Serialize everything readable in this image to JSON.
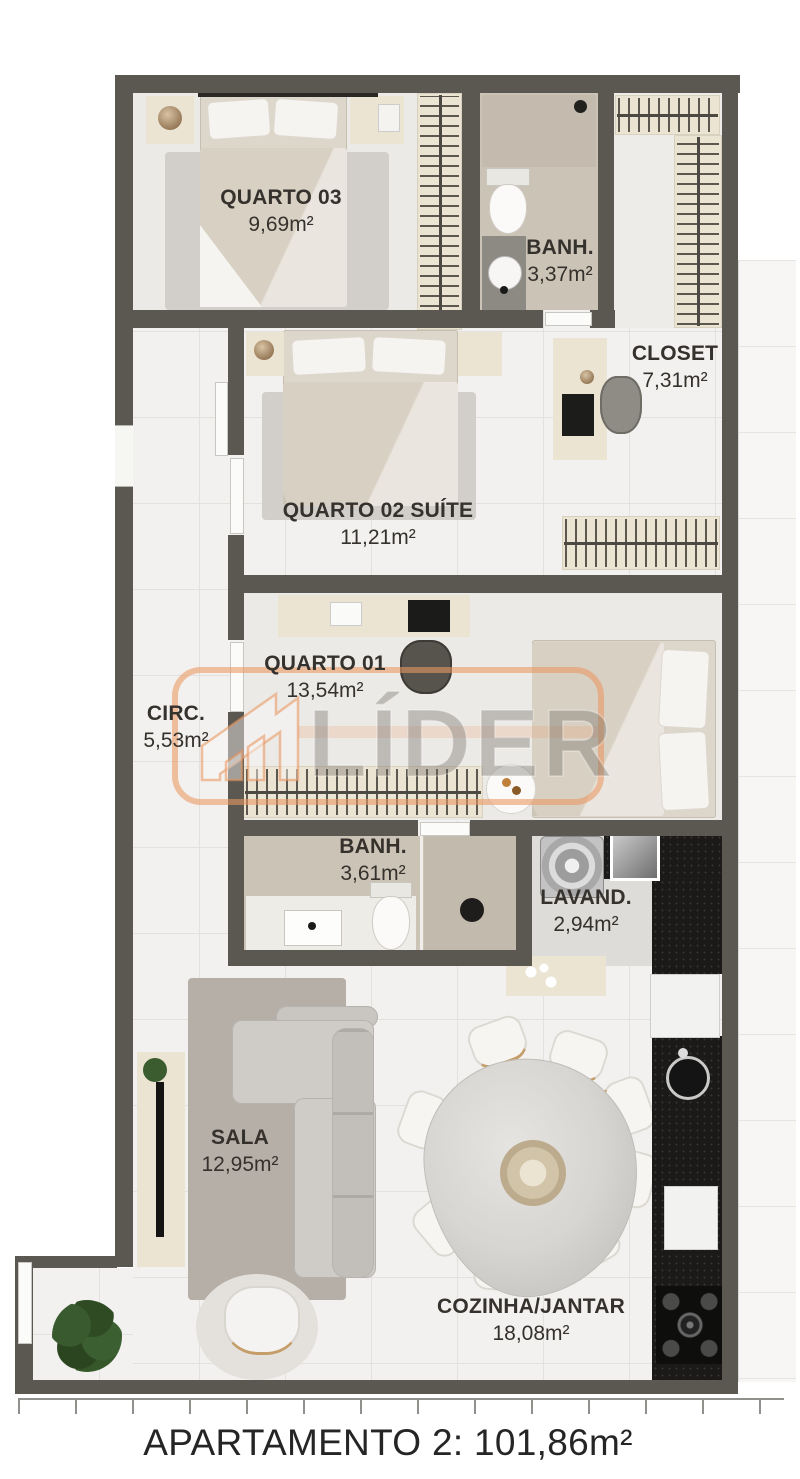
{
  "caption": "APARTAMENTO 2: 101,86m²",
  "watermark": {
    "brand": "LÍDER"
  },
  "rooms": [
    {
      "id": "quarto03",
      "name": "QUARTO 03",
      "area": "9,69m²"
    },
    {
      "id": "banh1",
      "name": "BANH.",
      "area": "3,37m²"
    },
    {
      "id": "closet",
      "name": "CLOSET",
      "area": "7,31m²"
    },
    {
      "id": "quarto02",
      "name": "QUARTO 02 SUÍTE",
      "area": "11,21m²"
    },
    {
      "id": "quarto01",
      "name": "QUARTO 01",
      "area": "13,54m²"
    },
    {
      "id": "circ",
      "name": "CIRC.",
      "area": "5,53m²"
    },
    {
      "id": "banh2",
      "name": "BANH.",
      "area": "3,61m²"
    },
    {
      "id": "lavand",
      "name": "LAVAND.",
      "area": "2,94m²"
    },
    {
      "id": "sala",
      "name": "SALA",
      "area": "12,95m²"
    },
    {
      "id": "cozinha",
      "name": "COZINHA/JANTAR",
      "area": "18,08m²"
    }
  ],
  "colors": {
    "wall": "#5b5751",
    "floor": "#f2f1ef",
    "grid": "#e3e1dd",
    "bath_floor": "#ccc3b7",
    "wardrobe": "#ece4d2",
    "counter": "#1b1a18",
    "accent_orange": "#e0925f",
    "label_ink": "#35312c"
  }
}
